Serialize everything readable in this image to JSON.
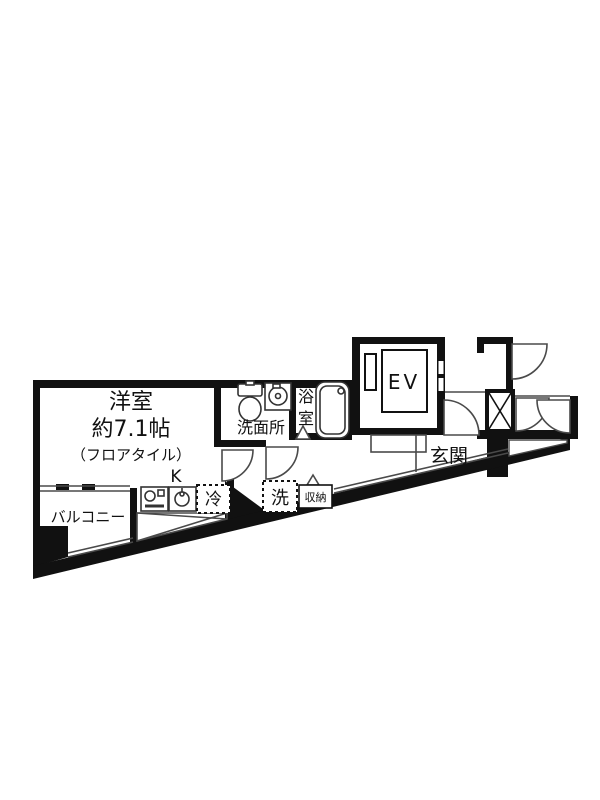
{
  "plan": {
    "type": "apartment-floor-plan",
    "colors": {
      "wall": "#111111",
      "thin_line": "#4a4a4a",
      "background": "#ffffff"
    },
    "rooms": {
      "main_room": {
        "name": "洋室",
        "size": "約7.1帖",
        "floor_note": "（フロアタイル）"
      },
      "kitchen": {
        "label": "K"
      },
      "balcony": {
        "label": "バルコニー"
      },
      "washroom": {
        "label": "洗面所"
      },
      "bathroom": {
        "label_chars": [
          "浴",
          "室"
        ]
      },
      "entrance": {
        "label": "玄関"
      },
      "elevator": {
        "label": "EV"
      }
    },
    "fixtures": {
      "fridge": {
        "label": "冷"
      },
      "washer": {
        "label": "洗"
      },
      "storage": {
        "label": "収納"
      }
    }
  }
}
